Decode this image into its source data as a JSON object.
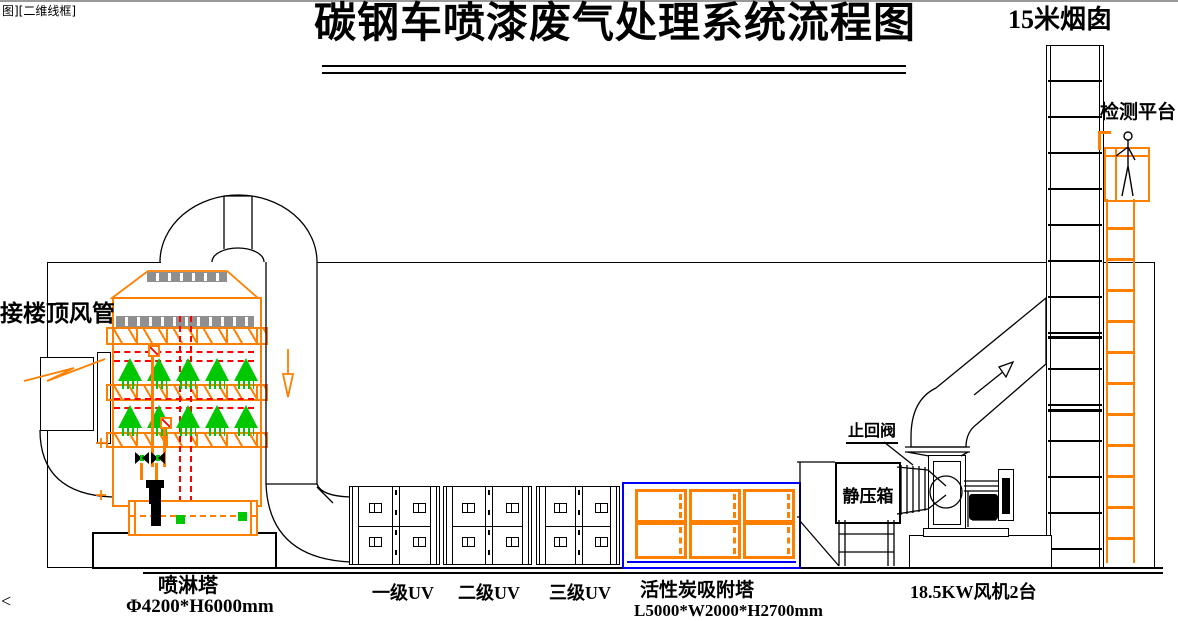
{
  "meta": {
    "viewport_label": "图][二维线框]",
    "corner_mark": "<"
  },
  "title": {
    "text": "碳钢车喷漆废气处理系统流程图"
  },
  "stack": {
    "label": "15米烟囱"
  },
  "platform": {
    "label": "检测平台"
  },
  "inlet": {
    "label": "接楼顶风管"
  },
  "spray_tower": {
    "name": "喷淋塔",
    "size": "Φ4200*H6000mm"
  },
  "uv": {
    "stage1": "一级UV",
    "stage2": "二级UV",
    "stage3": "三级UV"
  },
  "carbon": {
    "name": "活性炭吸附塔",
    "size": "L5000*W2000*H2700mm"
  },
  "check_valve": {
    "label": "止回阀"
  },
  "plenum": {
    "label": "静压箱"
  },
  "fan": {
    "label": "18.5KW风机2台"
  },
  "colors": {
    "line": "#000000",
    "equipment_orange": "#FF7F00",
    "spray_green": "#00C800",
    "pipe_red": "#FF0000",
    "carbon_blue": "#0000FF",
    "demister_gray": "#8F8F8F"
  }
}
